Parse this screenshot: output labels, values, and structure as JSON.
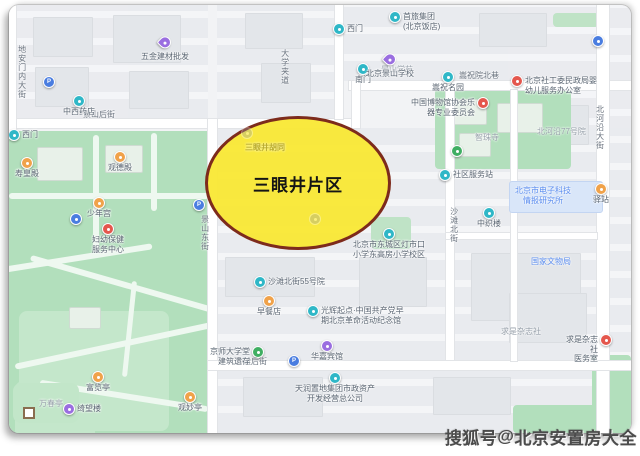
{
  "highlight": {
    "label": "三眼井片区"
  },
  "watermark": {
    "platform": "搜狐号",
    "separator": "@",
    "account": "北京安置房大全"
  },
  "colors": {
    "highlight_fill": "#f9e834",
    "highlight_border": "#7d2b1c",
    "park_green": "#b2dfbc",
    "teal": "#2fb7c7",
    "orange": "#f0a24a",
    "red": "#e4574d",
    "purple": "#9a6ee0",
    "blue": "#4a7de0",
    "blueP": "#4a7de0",
    "green": "#3fae62",
    "gray": "#9aa0a6",
    "label_gray": "#69727e",
    "label_blue": "#5b8def"
  },
  "map": {
    "streets": [
      {
        "text": "地安门内大街",
        "x": 8,
        "y": 40,
        "vert": true
      },
      {
        "text": "景山后街",
        "x": 74,
        "y": 105
      },
      {
        "text": "景山东街",
        "x": 191,
        "y": 210,
        "vert": true
      },
      {
        "text": "大学夹道",
        "x": 271,
        "y": 44,
        "vert": true
      },
      {
        "text": "嵩祝院北巷",
        "x": 450,
        "y": 66
      },
      {
        "text": "沙滩北街",
        "x": 440,
        "y": 202,
        "vert": true
      },
      {
        "text": "沙滩后街",
        "x": 226,
        "y": 352
      },
      {
        "text": "北河沿大街",
        "x": 586,
        "y": 100,
        "vert": true
      },
      {
        "text": "景山学苑",
        "x": 372,
        "y": 60,
        "area": true
      },
      {
        "text": "北河沿77号院",
        "x": 528,
        "y": 122,
        "area": true
      },
      {
        "text": "求是杂志社",
        "x": 492,
        "y": 322,
        "area": true
      },
      {
        "text": "智珠寺",
        "x": 466,
        "y": 128,
        "area": true
      },
      {
        "text": "国家文物局",
        "x": 522,
        "y": 252,
        "color": "blue"
      },
      {
        "text": "万春亭",
        "x": 30,
        "y": 394,
        "area": true
      },
      {
        "text": "北京市电子科技\n情报研究所",
        "x": 506,
        "y": 181,
        "boxed": true
      },
      {
        "text": "三眼井胡同",
        "x": 236,
        "y": 138,
        "overlay": true
      }
    ],
    "pois": [
      {
        "x": 156,
        "y": 41,
        "c": "purple",
        "pin": true,
        "label": "五金建材批发",
        "pos": "b"
      },
      {
        "x": 40,
        "y": 77,
        "c": "blueP",
        "glyph": "P"
      },
      {
        "x": 70,
        "y": 96,
        "c": "teal",
        "label": "中西药店",
        "pos": "b"
      },
      {
        "x": 5,
        "y": 130,
        "c": "teal",
        "label": "西门",
        "pos": "r"
      },
      {
        "x": 18,
        "y": 158,
        "c": "orange",
        "label": "寿皇殿",
        "pos": "b"
      },
      {
        "x": 111,
        "y": 152,
        "c": "orange",
        "label": "观德殿",
        "pos": "b"
      },
      {
        "x": 90,
        "y": 198,
        "c": "orange",
        "label": "少年宫",
        "pos": "b"
      },
      {
        "x": 99,
        "y": 224,
        "c": "red",
        "lines": [
          "妇幼保健",
          "服务中心"
        ],
        "pos": "b"
      },
      {
        "x": 67,
        "y": 214,
        "c": "blue"
      },
      {
        "x": 89,
        "y": 372,
        "c": "orange",
        "label": "富览亭",
        "pos": "b"
      },
      {
        "x": 181,
        "y": 392,
        "c": "orange",
        "label": "观妙亭",
        "pos": "b"
      },
      {
        "x": 60,
        "y": 404,
        "c": "purple",
        "label": "绮望楼",
        "pos": "r"
      },
      {
        "x": 330,
        "y": 24,
        "c": "teal",
        "label": "西门",
        "pos": "r"
      },
      {
        "x": 354,
        "y": 64,
        "c": "teal",
        "label": "南门",
        "pos": "b"
      },
      {
        "x": 381,
        "y": 58,
        "c": "purple",
        "pin": true,
        "label": "北京景山学校",
        "pos": "b"
      },
      {
        "x": 386,
        "y": 12,
        "c": "teal",
        "lines": [
          "首旅集团",
          "(北京饭店)"
        ],
        "pos": "r"
      },
      {
        "x": 589,
        "y": 36,
        "c": "blue"
      },
      {
        "x": 439,
        "y": 72,
        "c": "teal",
        "label": "嵩祝名园",
        "pos": "b"
      },
      {
        "x": 474,
        "y": 98,
        "c": "red",
        "lines": [
          "中国博物馆协会乐",
          "器专业委员会"
        ],
        "pos": "l"
      },
      {
        "x": 448,
        "y": 146,
        "c": "green"
      },
      {
        "x": 508,
        "y": 76,
        "c": "red",
        "lines": [
          "北京社工委民政局婴",
          "幼儿服务办公室"
        ],
        "pos": "r"
      },
      {
        "x": 592,
        "y": 184,
        "c": "orange",
        "label": "驿站",
        "pos": "b"
      },
      {
        "x": 480,
        "y": 208,
        "c": "teal",
        "label": "中织楼",
        "pos": "b"
      },
      {
        "x": 436,
        "y": 170,
        "c": "teal",
        "label": "社区服务站",
        "pos": "r"
      },
      {
        "x": 380,
        "y": 229,
        "c": "teal",
        "lines": [
          "北京市东城区灯市口",
          "小学东高房小学校区"
        ],
        "pos": "b"
      },
      {
        "x": 190,
        "y": 200,
        "c": "blueP",
        "glyph": "P"
      },
      {
        "x": 251,
        "y": 277,
        "c": "teal",
        "label": "沙滩北街55号院",
        "pos": "r"
      },
      {
        "x": 260,
        "y": 296,
        "c": "orange",
        "label": "早餐店",
        "pos": "b"
      },
      {
        "x": 304,
        "y": 306,
        "c": "teal",
        "lines": [
          "光辉起点·中国共产党早",
          "期北京革命活动纪念馆"
        ],
        "pos": "r"
      },
      {
        "x": 249,
        "y": 347,
        "c": "green",
        "lines": [
          "京师大学堂",
          "建筑遗存"
        ],
        "pos": "l"
      },
      {
        "x": 285,
        "y": 356,
        "c": "blueP",
        "glyph": "P"
      },
      {
        "x": 318,
        "y": 341,
        "c": "purple",
        "label": "华嘉宾馆",
        "pos": "b"
      },
      {
        "x": 326,
        "y": 373,
        "c": "teal",
        "lines": [
          "天润置地集团市政资产",
          "开发经营总公司"
        ],
        "pos": "b"
      },
      {
        "x": 597,
        "y": 335,
        "c": "red",
        "lines": [
          "求是杂志社",
          "医务室"
        ],
        "pos": "l"
      },
      {
        "x": 238,
        "y": 128,
        "c": "gray",
        "dim": true
      },
      {
        "x": 306,
        "y": 214,
        "c": "gray",
        "dim": true
      }
    ]
  }
}
